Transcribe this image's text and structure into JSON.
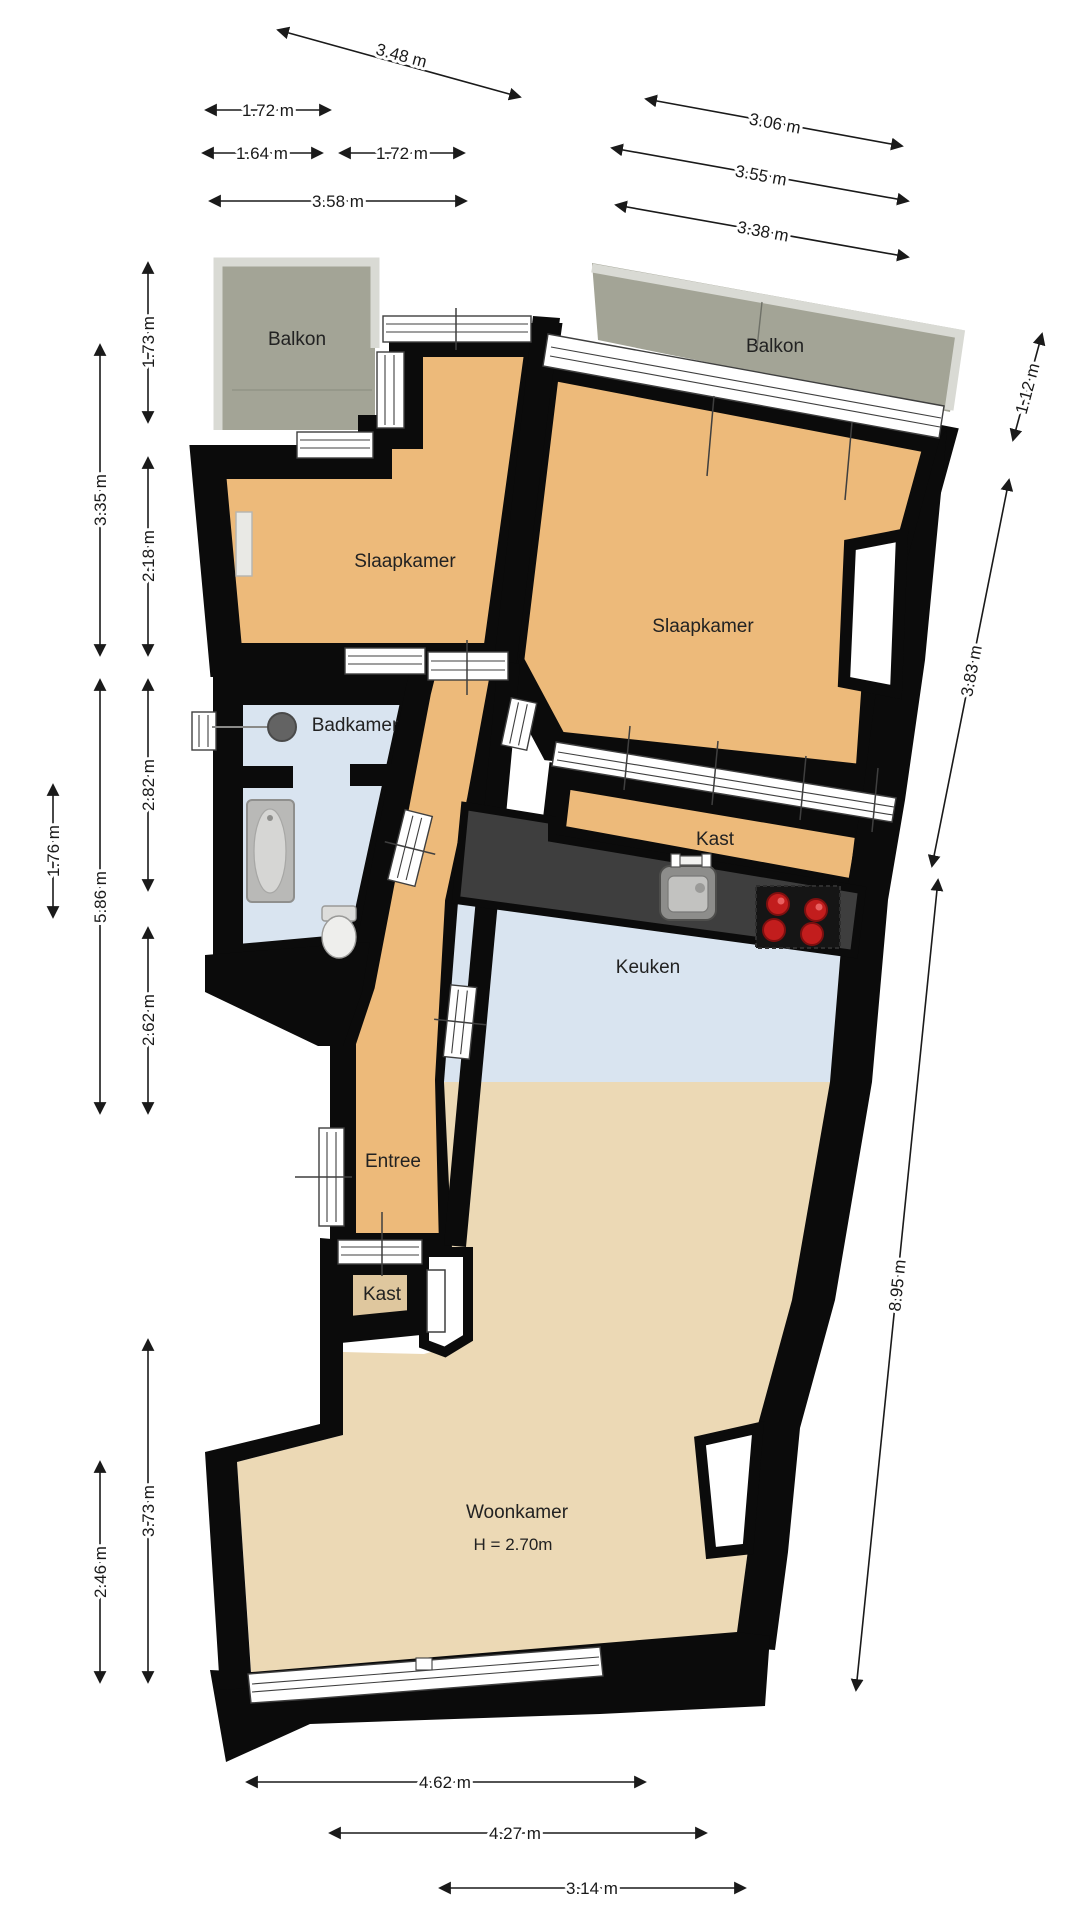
{
  "plan": {
    "type": "floorplan",
    "language": "nl",
    "rooms": {
      "balkon_left": "Balkon",
      "balkon_right": "Balkon",
      "slaapkamer_left": "Slaapkamer",
      "slaapkamer_right": "Slaapkamer",
      "badkamer": "Badkamer",
      "kast_boven": "Kast",
      "keuken": "Keuken",
      "entree": "Entree",
      "kast_onder": "Kast",
      "woonkamer": "Woonkamer",
      "woonkamer_hoogte": "H = 2.70m"
    },
    "dimensions": {
      "top": [
        {
          "label": "3.48 m"
        },
        {
          "label": "1.72 m"
        },
        {
          "label": "1.64 m"
        },
        {
          "label": "1.72 m"
        },
        {
          "label": "3.58 m"
        },
        {
          "label": "3.06 m"
        },
        {
          "label": "3.55 m"
        },
        {
          "label": "3.38 m"
        }
      ],
      "left": [
        {
          "label": "1.73 m"
        },
        {
          "label": "3.35 m"
        },
        {
          "label": "2.18 m"
        },
        {
          "label": "2.82 m"
        },
        {
          "label": "5.86 m"
        },
        {
          "label": "1.76 m"
        },
        {
          "label": "2.62 m"
        },
        {
          "label": "3.73 m"
        },
        {
          "label": "2.46 m"
        }
      ],
      "right": [
        {
          "label": "1.12 m"
        },
        {
          "label": "3.83 m"
        },
        {
          "label": "8.95 m"
        }
      ],
      "bottom": [
        {
          "label": "4.62 m"
        },
        {
          "label": "4.27 m"
        },
        {
          "label": "3.14 m"
        }
      ]
    },
    "colors": {
      "wall": "#0b0b0b",
      "floor_orange": "#edba7a",
      "floor_livingroom": "#ecd9b5",
      "floor_closet": "#dfc79e",
      "floor_wet": "#d9e4f0",
      "balcony": "#a3a496",
      "railing": "#d9dad4",
      "counter": "#3e3e3e",
      "burner_red": "#c21d1d"
    }
  }
}
